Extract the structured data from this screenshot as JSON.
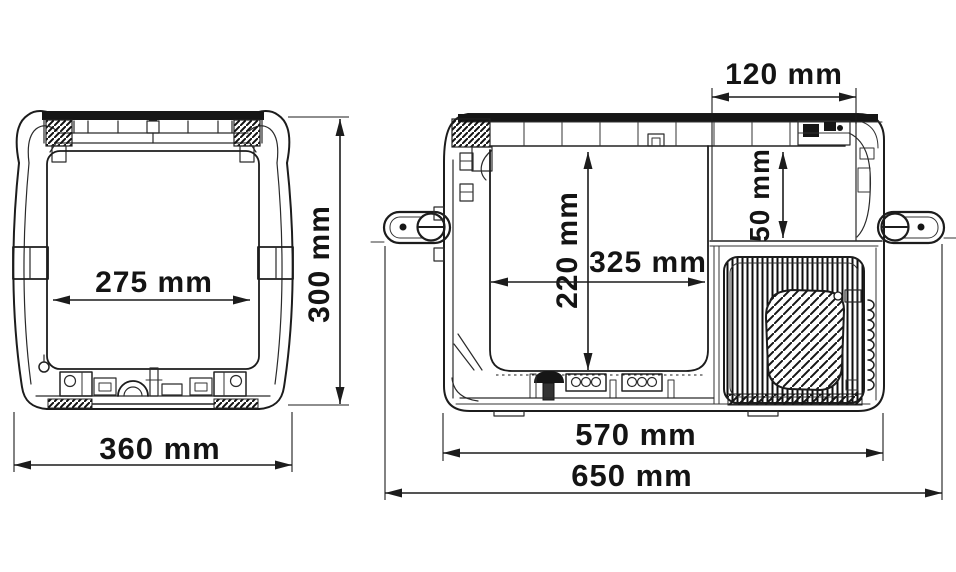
{
  "diagram": {
    "type": "technical-drawing",
    "subject": "portable compressor cooler dimensional drawing, front view and side view",
    "unit": "mm",
    "colors": {
      "line": "#1c1c1c",
      "background": "#ffffff"
    },
    "dimensions": {
      "front_interior_width": {
        "value": 275,
        "unit": "mm",
        "label": "275 mm"
      },
      "front_overall_width": {
        "value": 360,
        "unit": "mm",
        "label": "360 mm"
      },
      "front_overall_height": {
        "value": 300,
        "unit": "mm",
        "label": "300 mm"
      },
      "side_recess_width": {
        "value": 120,
        "unit": "mm",
        "label": "120 mm"
      },
      "side_interior_height": {
        "value": 220,
        "unit": "mm",
        "label": "220 mm"
      },
      "side_interior_length": {
        "value": 325,
        "unit": "mm",
        "label": "325 mm"
      },
      "side_recess_height": {
        "value": 50,
        "unit": "mm",
        "label": "50 mm"
      },
      "side_body_length": {
        "value": 570,
        "unit": "mm",
        "label": "570 mm"
      },
      "side_overall_length": {
        "value": 650,
        "unit": "mm",
        "label": "650 mm"
      }
    }
  }
}
